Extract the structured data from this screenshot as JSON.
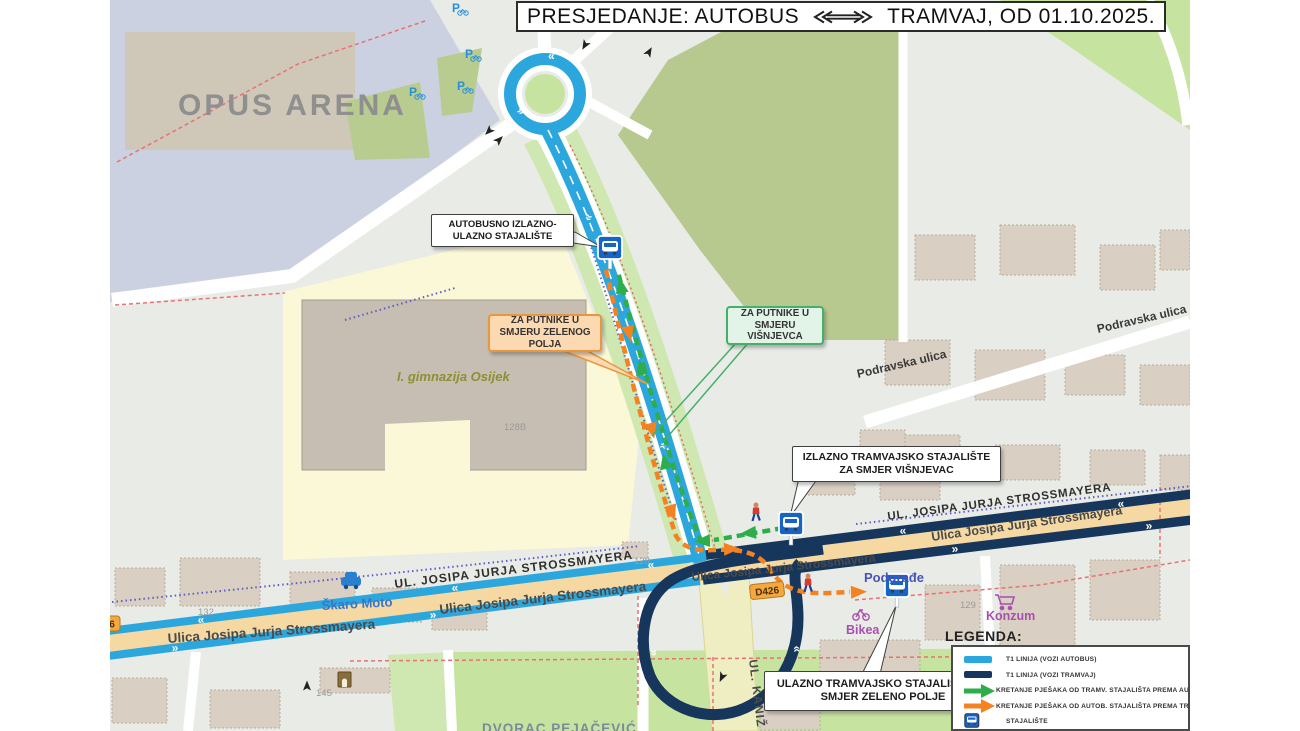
{
  "title": {
    "left": "PRESJEDANJE:  AUTOBUS",
    "right": "TRAMVAJ, OD 01.10.2025."
  },
  "callouts": {
    "bus_stop": "AUTOBUSNO IZLAZNO-ULAZNO STAJALIŠTE",
    "passengers_zeleno": "ZA PUTNIKE U SMJERU ZELENOG POLJA",
    "passengers_visnjevac": "ZA PUTNIKE U SMJERU VIŠNJEVCA",
    "tram_exit": "IZLAZNO TRAMVAJSKO STAJALIŠTE ZA SMJER VIŠNJEVAC",
    "tram_enter": "ULAZNO TRAMVAJSKO STAJALIŠTE ZA SMJER ZELENO POLJE"
  },
  "legend": {
    "heading": "LEGENDA:",
    "items": [
      {
        "swatch": "bus-line",
        "color": "#2BA7DE",
        "label": "T1 LINIJA (VOZI AUTOBUS)"
      },
      {
        "swatch": "tram-line",
        "color": "#16365C",
        "label": "T1 LINIJA (VOZI TRAMVAJ)"
      },
      {
        "swatch": "walk-arrow-green",
        "color": "#2EAE4B",
        "label": "KRETANJE PJEŠAKA OD TRAMV. STAJALIŠTA  PREMA  AUTOB. STAJALIŠTU"
      },
      {
        "swatch": "walk-arrow-orange",
        "color": "#F58220",
        "label": "KRETANJE PJEŠAKA OD AUTOB. STAJALIŠTA  PREMA  TRAMV. STAJALIŠTU"
      },
      {
        "swatch": "stop-icon",
        "color": "#1565C8",
        "label": "STAJALIŠTE"
      }
    ]
  },
  "map": {
    "areas": {
      "opus_arena": "OPUS ARENA",
      "gimnazija": "I. gimnazija Osijek",
      "dvorac": "DVORAC PEJAČEVIĆ",
      "podgrade": "Podgrađe"
    },
    "streets": {
      "strossmayera_caps": "UL. JOSIPA JURJA STROSSMAYERA",
      "strossmayera": "Ulica Josipa Jurja Strossmayera",
      "podravska": "Podravska ulica",
      "kaniz": "UL. KANIŽ",
      "d426": "D426",
      "d426_cut": "6"
    },
    "poi": {
      "skaro_moto": "Škaro Moto",
      "bikea": "Bikea",
      "konzum": "Konzum"
    },
    "house_numbers": {
      "n128b": "128B",
      "n128": "128",
      "n129": "129",
      "n132": "132",
      "n145": "145"
    },
    "glyphs": {
      "chev_left": "«",
      "chev_right": "»",
      "parking": "P"
    }
  },
  "colors": {
    "bus_line": "#2BA7DE",
    "tram_line": "#16365C",
    "walk_green": "#2EAE4B",
    "walk_orange": "#F58220",
    "road_fill": "#F6D9A2",
    "park": "#C6E4A0",
    "school_grounds": "#FBF8D8",
    "stadium_area": "#CCD1E1"
  }
}
